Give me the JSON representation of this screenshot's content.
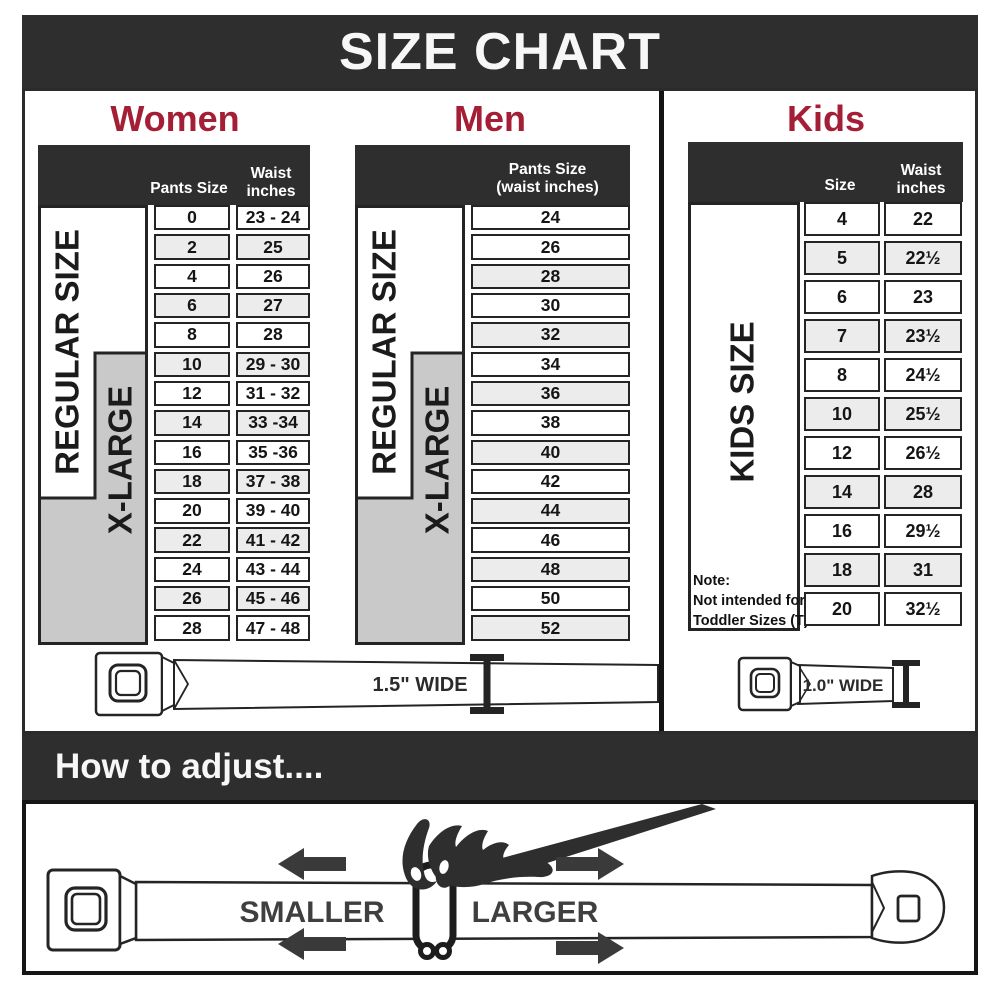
{
  "banner": {
    "title": "SIZE CHART"
  },
  "sections": {
    "women": {
      "title": "Women",
      "header_pants": "Pants Size",
      "header_waist1": "Waist",
      "header_waist2": "inches",
      "regular_label": "REGULAR SIZE",
      "xlarge_label": "X-LARGE",
      "rows": [
        {
          "size": "0",
          "waist": "23 - 24"
        },
        {
          "size": "2",
          "waist": "25"
        },
        {
          "size": "4",
          "waist": "26"
        },
        {
          "size": "6",
          "waist": "27"
        },
        {
          "size": "8",
          "waist": "28"
        },
        {
          "size": "10",
          "waist": "29 - 30"
        },
        {
          "size": "12",
          "waist": "31 - 32"
        },
        {
          "size": "14",
          "waist": "33 -34"
        },
        {
          "size": "16",
          "waist": "35 -36"
        },
        {
          "size": "18",
          "waist": "37 - 38"
        },
        {
          "size": "20",
          "waist": "39 - 40"
        },
        {
          "size": "22",
          "waist": "41 - 42"
        },
        {
          "size": "24",
          "waist": "43 - 44"
        },
        {
          "size": "26",
          "waist": "45 - 46"
        },
        {
          "size": "28",
          "waist": "47 - 48"
        }
      ]
    },
    "men": {
      "title": "Men",
      "header_line1": "Pants Size",
      "header_line2": "(waist inches)",
      "regular_label": "REGULAR SIZE",
      "xlarge_label": "X-LARGE",
      "rows": [
        "24",
        "26",
        "28",
        "30",
        "32",
        "34",
        "36",
        "38",
        "40",
        "42",
        "44",
        "46",
        "48",
        "50",
        "52"
      ]
    },
    "kids": {
      "title": "Kids",
      "header_size": "Size",
      "header_waist1": "Waist",
      "header_waist2": "inches",
      "side_label": "KIDS SIZE",
      "note_line1": "Note:",
      "note_line2": "Not intended for",
      "note_line3": "Toddler Sizes (T)",
      "rows": [
        {
          "size": "4",
          "waist": "22"
        },
        {
          "size": "5",
          "waist": "22½"
        },
        {
          "size": "6",
          "waist": "23"
        },
        {
          "size": "7",
          "waist": "23½"
        },
        {
          "size": "8",
          "waist": "24½"
        },
        {
          "size": "10",
          "waist": "25½"
        },
        {
          "size": "12",
          "waist": "26½"
        },
        {
          "size": "14",
          "waist": "28"
        },
        {
          "size": "16",
          "waist": "29½"
        },
        {
          "size": "18",
          "waist": "31"
        },
        {
          "size": "20",
          "waist": "32½"
        }
      ]
    }
  },
  "belts": {
    "adult_width_label": "1.5\" WIDE",
    "kids_width_label": "1.0\" WIDE"
  },
  "adjust": {
    "title": "How to adjust....",
    "smaller_label": "SMALLER",
    "larger_label": "LARGER"
  },
  "colors": {
    "accent": "#A41E35",
    "banner_bg": "#2E2E2E",
    "row_alt": "#ECECEC",
    "xlarge_gray": "#C9C9C9"
  },
  "chart_data": [
    {
      "type": "table",
      "title": "Women",
      "columns": [
        "Pants Size",
        "Waist inches"
      ],
      "rows": [
        [
          "0",
          "23 - 24"
        ],
        [
          "2",
          "25"
        ],
        [
          "4",
          "26"
        ],
        [
          "6",
          "27"
        ],
        [
          "8",
          "28"
        ],
        [
          "10",
          "29 - 30"
        ],
        [
          "12",
          "31 - 32"
        ],
        [
          "14",
          "33 -34"
        ],
        [
          "16",
          "35 -36"
        ],
        [
          "18",
          "37 - 38"
        ],
        [
          "20",
          "39 - 40"
        ],
        [
          "22",
          "41 - 42"
        ],
        [
          "24",
          "43 - 44"
        ],
        [
          "26",
          "45 - 46"
        ],
        [
          "28",
          "47 - 48"
        ]
      ],
      "groups": [
        {
          "label": "REGULAR SIZE",
          "from": "0",
          "to": "18"
        },
        {
          "label": "X-LARGE",
          "from": "10",
          "to": "28"
        }
      ],
      "belt_width": "1.5\" WIDE"
    },
    {
      "type": "table",
      "title": "Men",
      "columns": [
        "Pants Size (waist inches)"
      ],
      "rows": [
        [
          "24"
        ],
        [
          "26"
        ],
        [
          "28"
        ],
        [
          "30"
        ],
        [
          "32"
        ],
        [
          "34"
        ],
        [
          "36"
        ],
        [
          "38"
        ],
        [
          "40"
        ],
        [
          "42"
        ],
        [
          "44"
        ],
        [
          "46"
        ],
        [
          "48"
        ],
        [
          "50"
        ],
        [
          "52"
        ]
      ],
      "groups": [
        {
          "label": "REGULAR SIZE",
          "from": "24",
          "to": "42"
        },
        {
          "label": "X-LARGE",
          "from": "34",
          "to": "52"
        }
      ],
      "belt_width": "1.5\" WIDE"
    },
    {
      "type": "table",
      "title": "Kids",
      "columns": [
        "Size",
        "Waist inches"
      ],
      "rows": [
        [
          "4",
          "22"
        ],
        [
          "5",
          "22½"
        ],
        [
          "6",
          "23"
        ],
        [
          "7",
          "23½"
        ],
        [
          "8",
          "24½"
        ],
        [
          "10",
          "25½"
        ],
        [
          "12",
          "26½"
        ],
        [
          "14",
          "28"
        ],
        [
          "16",
          "29½"
        ],
        [
          "18",
          "31"
        ],
        [
          "20",
          "32½"
        ]
      ],
      "groups": [
        {
          "label": "KIDS SIZE",
          "from": "4",
          "to": "20"
        }
      ],
      "note": "Note: Not intended for Toddler Sizes (T)",
      "belt_width": "1.0\" WIDE"
    }
  ]
}
